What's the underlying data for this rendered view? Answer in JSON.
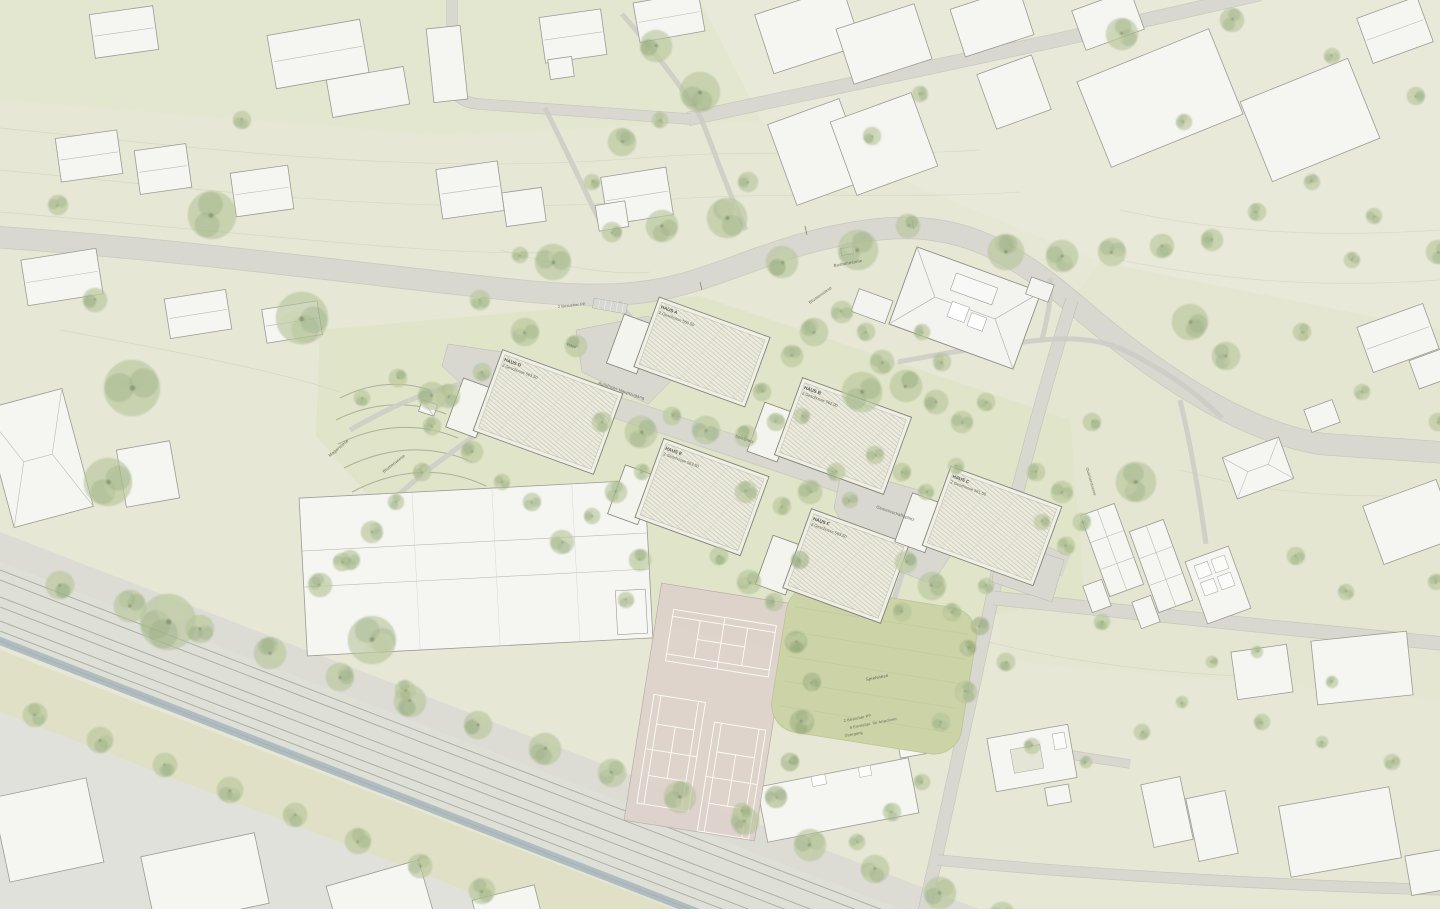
{
  "plan": {
    "type": "architectural-site-plan",
    "houses": [
      {
        "id": "haus-d",
        "name": "HAUS D",
        "floors": "2 Geschosse 563.50",
        "cx": 548,
        "cy": 412,
        "w": 128,
        "h": 86,
        "angle": 20
      },
      {
        "id": "haus-a",
        "name": "HAUS A",
        "floors": "2 Geschosse 560.50",
        "cx": 702,
        "cy": 352,
        "w": 118,
        "h": 74,
        "angle": 20
      },
      {
        "id": "haus-e",
        "name": "HAUS E",
        "floors": "2 Geschosse 563.50",
        "cx": 702,
        "cy": 497,
        "w": 112,
        "h": 84,
        "angle": 20
      },
      {
        "id": "haus-b",
        "name": "HAUS B",
        "floors": "2 Geschosse 562.00",
        "cx": 843,
        "cy": 436,
        "w": 116,
        "h": 82,
        "angle": 20
      },
      {
        "id": "haus-f",
        "name": "HAUS F",
        "floors": "2 Geschosse 563.50",
        "cx": 846,
        "cy": 566,
        "w": 104,
        "h": 84,
        "angle": 20
      },
      {
        "id": "haus-c",
        "name": "HAUS C",
        "floors": "2 Geschosse 561.00",
        "cx": 992,
        "cy": 526,
        "w": 118,
        "h": 84,
        "angle": 20
      }
    ],
    "site_labels": [
      {
        "text": "Autofreier Hauptzugang",
        "x": 598,
        "y": 384,
        "rot": 19,
        "fs": 4.2
      },
      {
        "text": "Gemeinschaftsplatz",
        "x": 876,
        "y": 508,
        "rot": 19,
        "fs": 4.2
      },
      {
        "text": "Bushaltestelle",
        "x": 834,
        "y": 267,
        "rot": -10,
        "fs": 4.2
      },
      {
        "text": "Blumenwiese",
        "x": 810,
        "y": 304,
        "rot": -35,
        "fs": 4.2
      },
      {
        "text": "Blumenwiese",
        "x": 384,
        "y": 473,
        "rot": -38,
        "fs": 4.2
      },
      {
        "text": "Magerwiese",
        "x": 330,
        "y": 457,
        "rot": -40,
        "fs": 4.2
      },
      {
        "text": "Spielwiese",
        "x": 866,
        "y": 681,
        "rot": -11,
        "fs": 4.4
      },
      {
        "text": "2 Besucher PP",
        "x": 844,
        "y": 722,
        "rot": -11,
        "fs": 3.8
      },
      {
        "text": "8 Einstellpl. für Anwohner",
        "x": 850,
        "y": 729,
        "rot": -11,
        "fs": 3.8
      },
      {
        "text": "Übergang",
        "x": 845,
        "y": 737,
        "rot": -11,
        "fs": 3.8
      },
      {
        "text": "2 Besucher PP",
        "x": 558,
        "y": 308,
        "rot": -6,
        "fs": 3.8
      },
      {
        "text": "Spielplatz",
        "x": 735,
        "y": 437,
        "rot": 19,
        "fs": 4.0
      },
      {
        "text": "Velos",
        "x": 566,
        "y": 345,
        "rot": 19,
        "fs": 3.8
      },
      {
        "text": "Quartierstrasse",
        "x": 1086,
        "y": 468,
        "rot": 74,
        "fs": 3.8
      }
    ],
    "symbols": {
      "tree": "green-canopy",
      "new_building_roof": "pv-panel-hatch",
      "existing_building": "white-footprint",
      "railway": "parallel-tracks",
      "canal": "blue-grey-channel",
      "tennis": "rose-court-white-lines"
    },
    "palette": {
      "meadow": "#e6e7d5",
      "meadow_core": "#dfe3c5",
      "meadow_light": "#e9e9da",
      "paving": "#d8d8d1",
      "road_edge": "#aeaea6",
      "building_fill": "#f5f5f2",
      "building_stroke": "#9b9b93",
      "new_roof": "#ecebdd",
      "panel_line": "#c7c8b8",
      "new_stroke": "#83837a",
      "tree_green": "#b7c59a",
      "tree_dark": "#93a87c",
      "tennis": "#ded3cc",
      "field": "#cbd3a7",
      "canal": "#b1bcc0",
      "rail_line": "#a6a6a0",
      "contour": "#c8ccb2",
      "label": "#64645c"
    }
  }
}
